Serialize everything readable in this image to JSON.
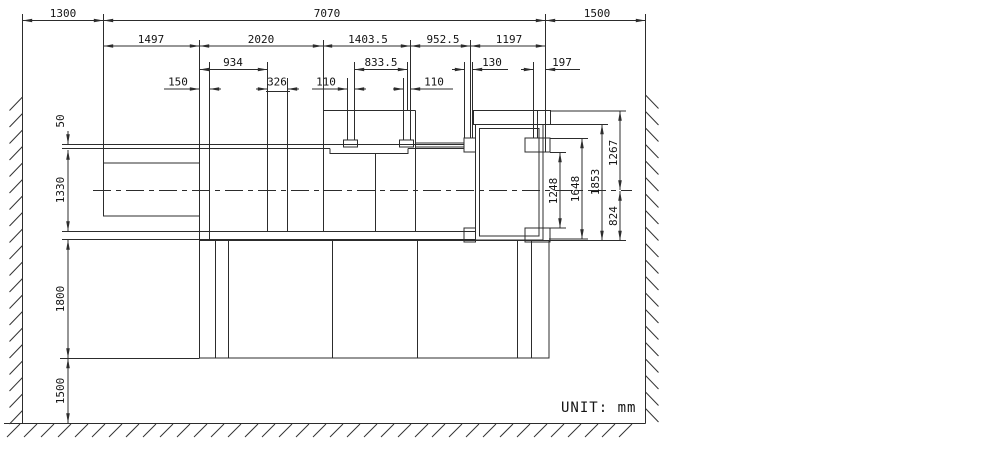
{
  "drawing": {
    "unit_note": "UNIT: mm",
    "dimensions": {
      "top_row": {
        "left_offset": "1300",
        "machine_overall": "7070",
        "right_offset": "1500"
      },
      "section_row": {
        "seg1": "1497",
        "seg2": "2020",
        "seg3": "1403.5",
        "seg4": "952.5",
        "seg5": "1197"
      },
      "detail_row_upper": {
        "d934": "934",
        "d833_5": "833.5",
        "d130": "130",
        "d197": "197"
      },
      "detail_row_lower": {
        "d150": "150",
        "d326": "326",
        "d110_left": "110",
        "d110_right": "110"
      },
      "left_column": {
        "d50": "50",
        "d1330": "1330",
        "d1800": "1800",
        "d1500": "1500"
      },
      "right_column": {
        "d1248": "1248",
        "d1648": "1648",
        "d1853": "1853",
        "d1267": "1267",
        "d824": "824"
      }
    }
  }
}
